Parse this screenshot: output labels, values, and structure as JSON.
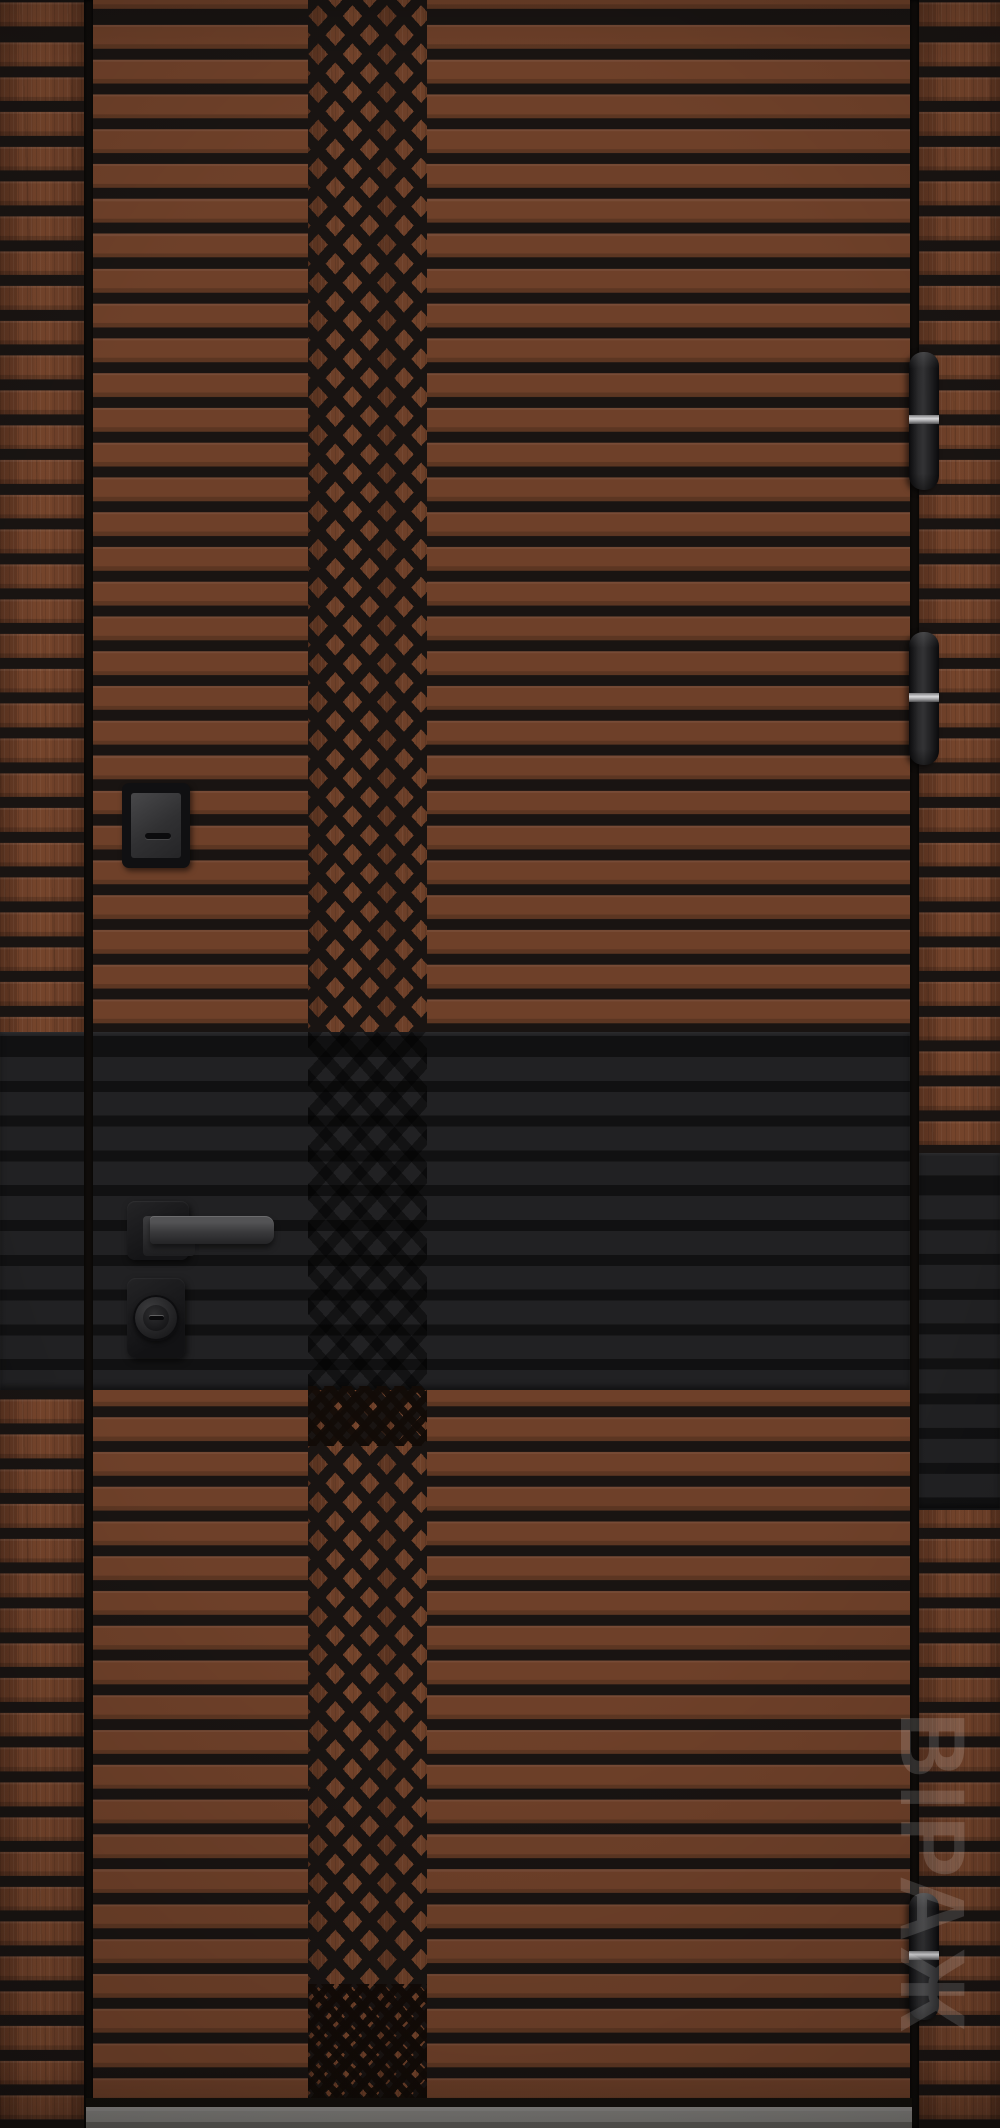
{
  "scene": {
    "type": "product-photo",
    "subject": "entrance door, dark walnut finish with horizontal milled slats, central diamond lattice band and black accent band"
  },
  "watermark": {
    "text": "ВІРАЖ"
  },
  "door": {
    "hinge_count": 3,
    "hardware_finish": "matte black",
    "hinge_ring_finish": "polished silver",
    "features": [
      "horizontal slat grooves",
      "central diamond lattice band",
      "black accent band with handle",
      "lever handle on square rose",
      "cylinder lock escutcheon",
      "upper lock keyhole cover",
      "frame gap left and right",
      "gray threshold sill"
    ]
  },
  "colors": {
    "wood_base": "#6e4029",
    "wood_dark_streak": "#4e2c1c",
    "wood_light_streak": "#8a5236",
    "groove": "#191412",
    "band": "#212123",
    "hardware": "#1c1c1e",
    "hinge_ring": "#c0c0c2",
    "threshold": "#8e8c88",
    "watermark": "rgba(255,255,255,0.16)"
  }
}
